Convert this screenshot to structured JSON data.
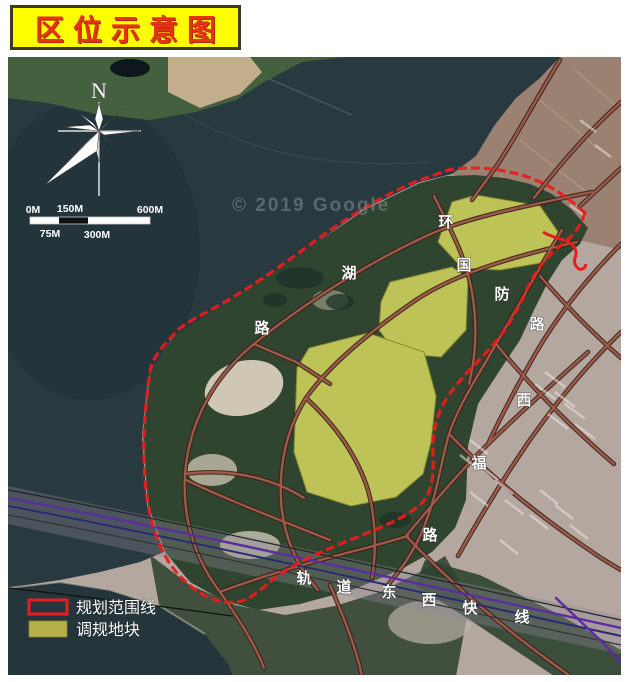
{
  "title": "区位示意图",
  "compass": {
    "north_label": "N"
  },
  "scale_bar": {
    "top_labels": [
      "0M",
      "150M",
      "600M"
    ],
    "bottom_labels": [
      "75M",
      "300M"
    ]
  },
  "watermark": "© 2019 Google",
  "road_names": [
    "环湖路",
    "国防路",
    "西福路",
    "轨道东西快线"
  ],
  "road_labels": [
    {
      "road": "huanhu-road",
      "char": "环"
    },
    {
      "road": "huanhu-road",
      "char": "湖"
    },
    {
      "road": "huanhu-road",
      "char": "路"
    },
    {
      "road": "guofang-road",
      "char": "国"
    },
    {
      "road": "guofang-road",
      "char": "防"
    },
    {
      "road": "guofang-road",
      "char": "路"
    },
    {
      "road": "xifu-road",
      "char": "西"
    },
    {
      "road": "xifu-road",
      "char": "福"
    },
    {
      "road": "xifu-road",
      "char": "路"
    },
    {
      "road": "rail-line",
      "char": "轨"
    },
    {
      "road": "rail-line",
      "char": "道"
    },
    {
      "road": "rail-line",
      "char": "东"
    },
    {
      "road": "rail-line",
      "char": "西"
    },
    {
      "road": "rail-line",
      "char": "快"
    },
    {
      "road": "rail-line",
      "char": "线"
    }
  ],
  "legend": {
    "items": [
      {
        "label": "规划范围线",
        "swatch": "planning-boundary",
        "color": "#e81d1d"
      },
      {
        "label": "调规地块",
        "swatch": "adjustment-plot",
        "color": "#b5b24a"
      }
    ]
  },
  "colors": {
    "title_bg": "#ffff00",
    "title_text": "#e53211",
    "boundary": "#e81d1d",
    "plot_fill": "#d7da5e",
    "water": "#283a40",
    "rail_purple": "#5b2d9e"
  }
}
